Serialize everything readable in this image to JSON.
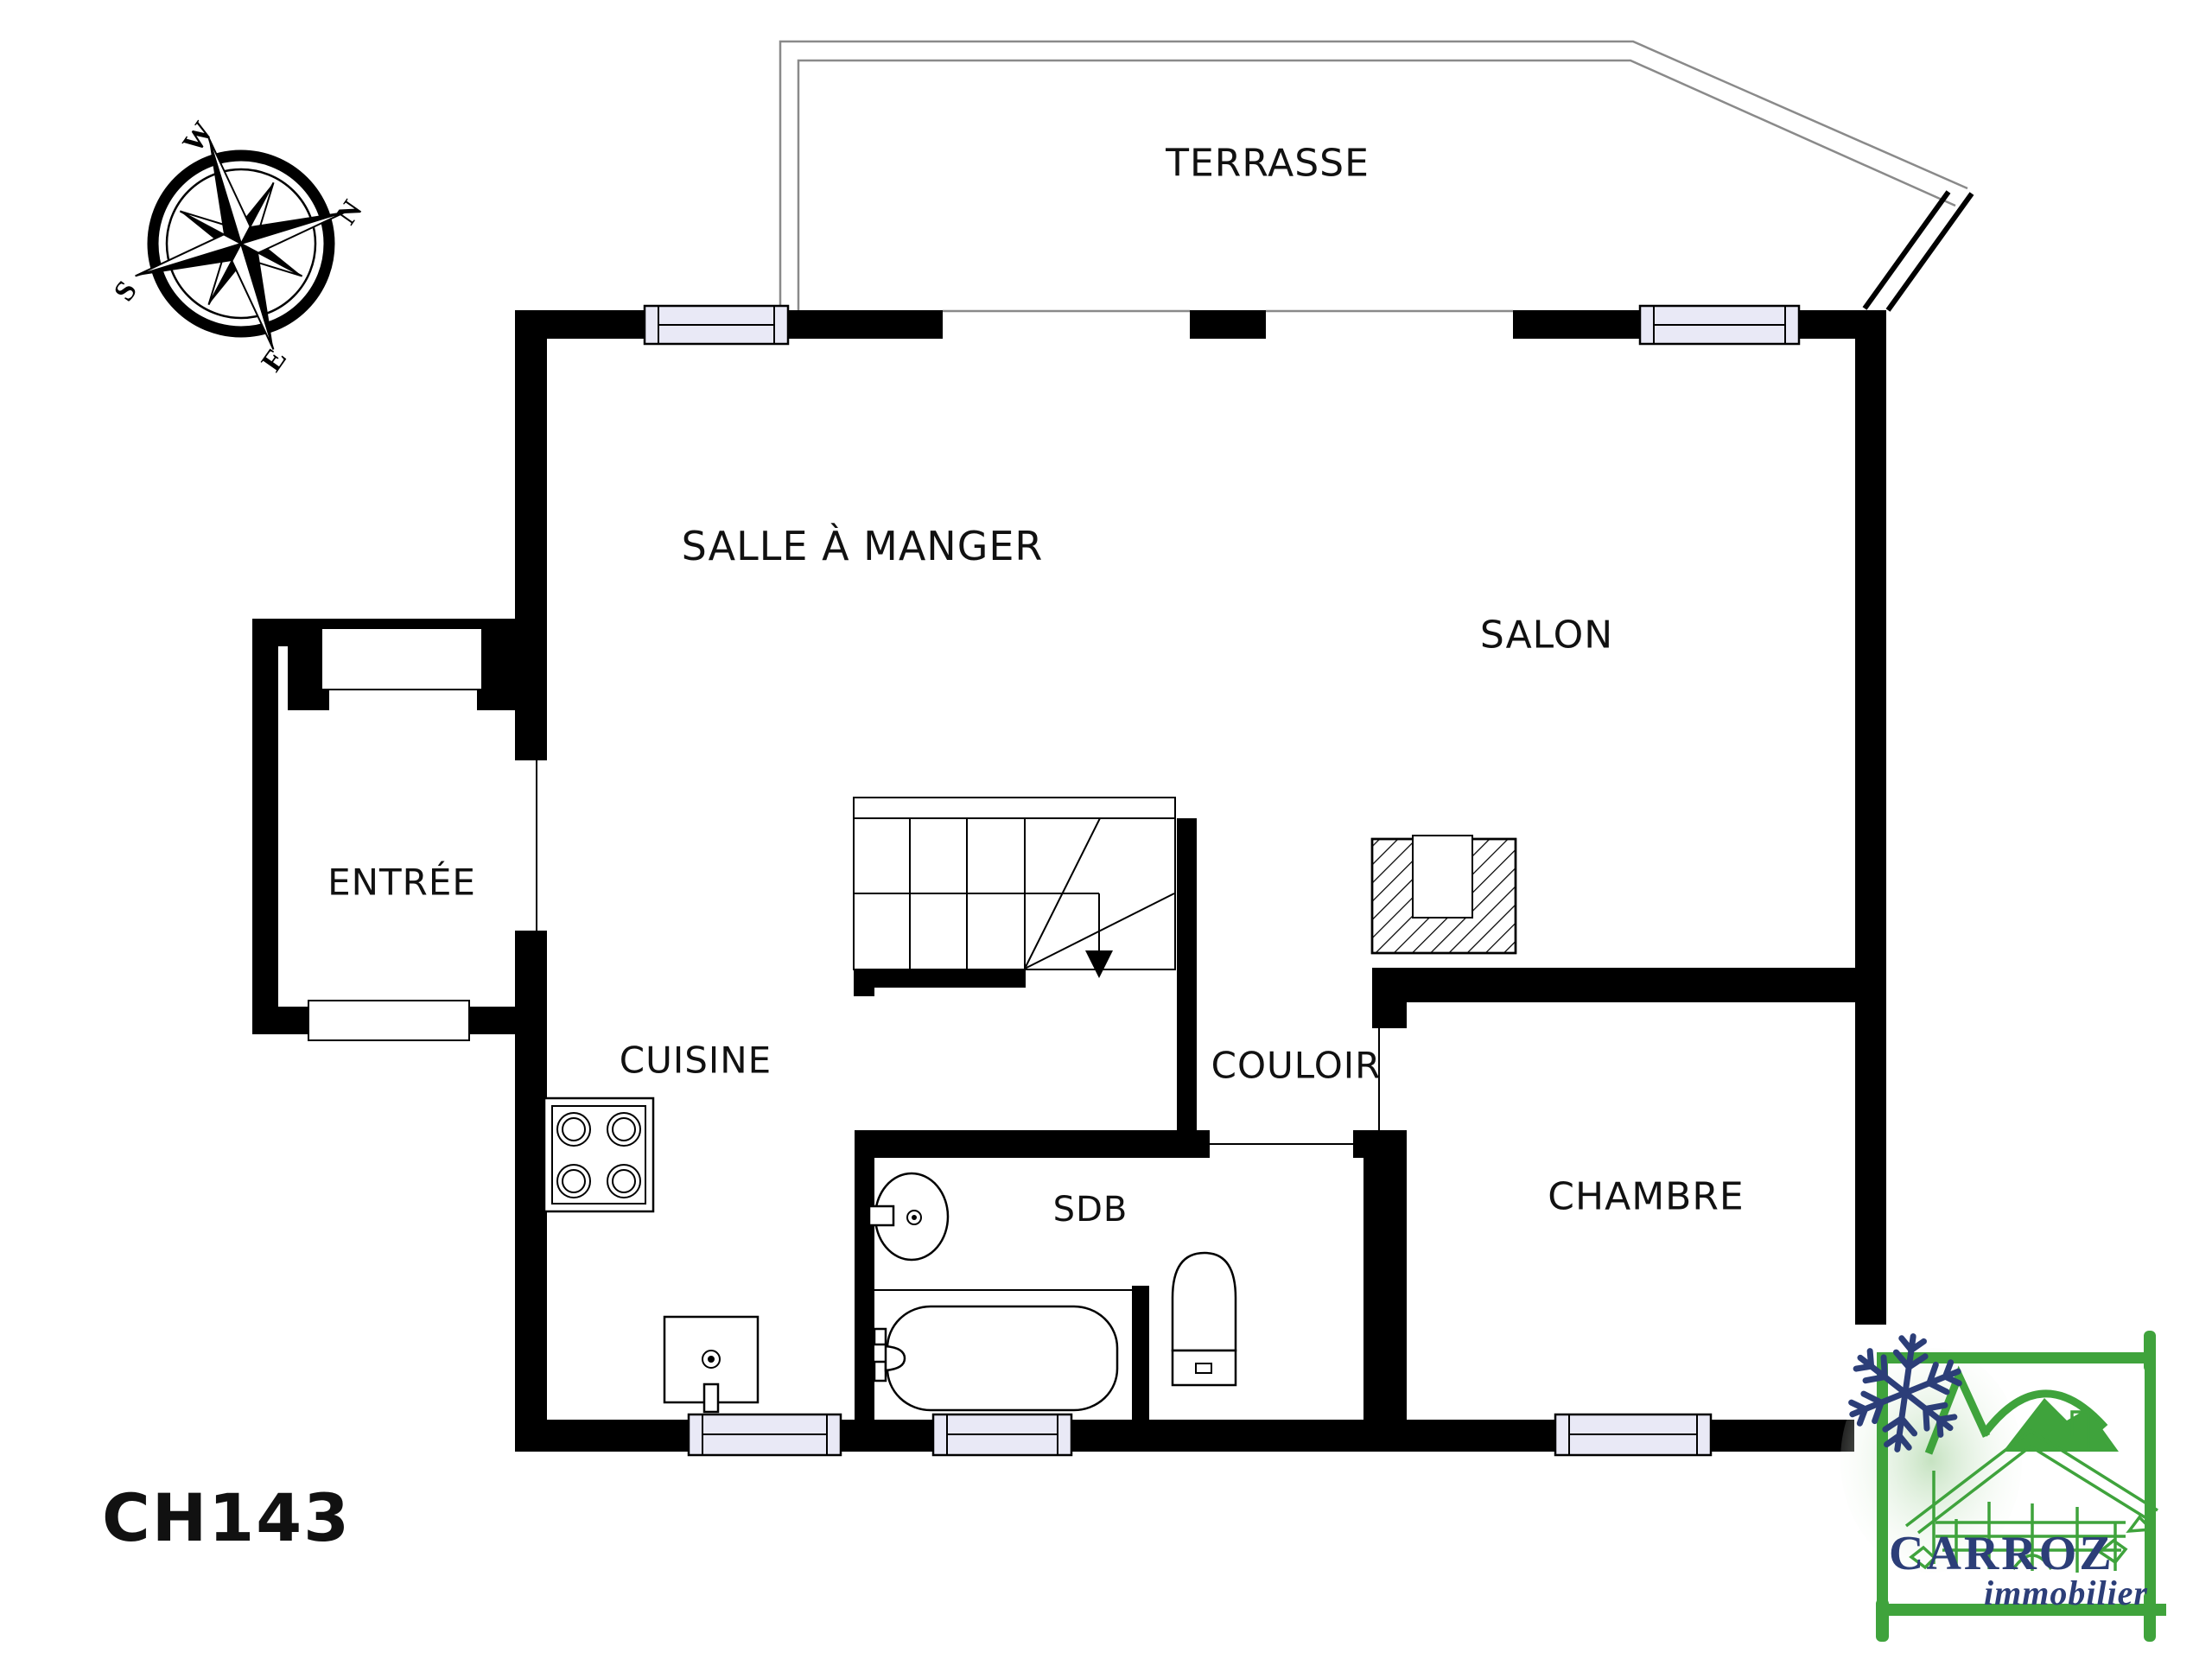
{
  "reference": "CH143",
  "rooms": {
    "terrasse": "TERRASSE",
    "salle_a_manger": "SALLE À MANGER",
    "salon": "SALON",
    "entree": "ENTRÉE",
    "cuisine": "CUISINE",
    "couloir": "COULOIR",
    "sdb": "SDB",
    "chambre": "CHAMBRE"
  },
  "compass": {
    "north": "N",
    "south": "S",
    "east": "E",
    "west": "W"
  },
  "logo": {
    "name": "CARROZ",
    "tagline": "immobilier"
  },
  "colors": {
    "wall": "#000000",
    "terrace_line": "#8a8a8a",
    "window_fill": "#e9e9f6",
    "logo_green": "#3fa33c",
    "logo_navy": "#2c3e78",
    "text": "#111111",
    "background": "#ffffff"
  }
}
